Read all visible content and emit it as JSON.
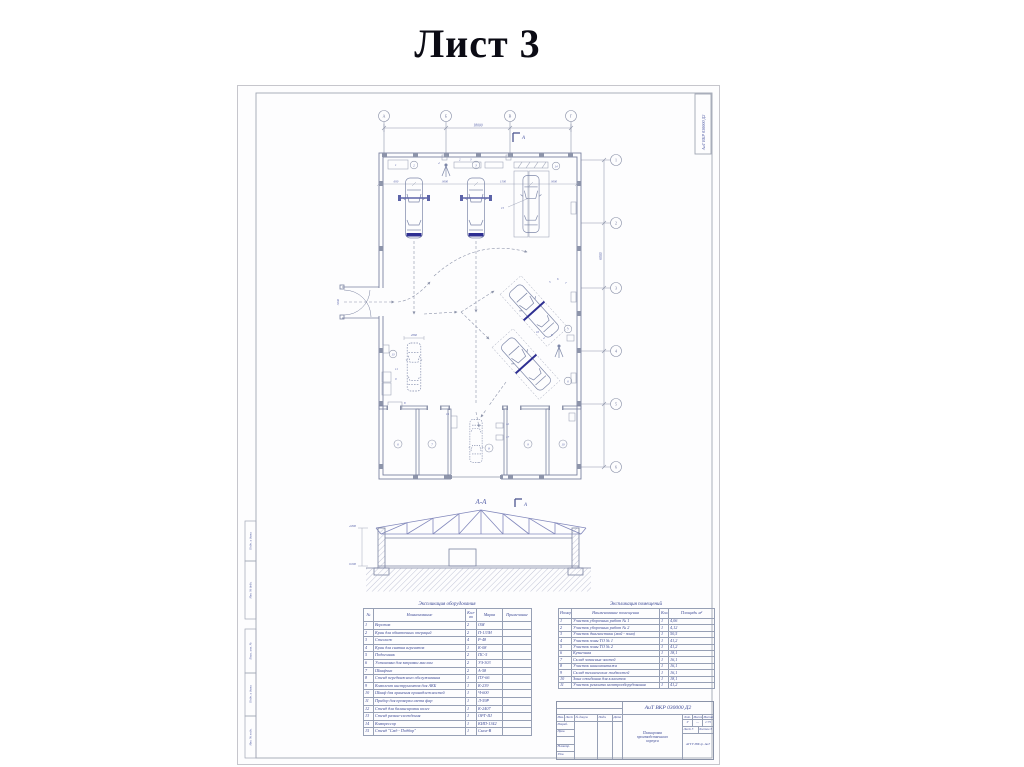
{
  "page": {
    "title": "Лист 3"
  },
  "sheet": {
    "code": "АиТ ВКР 030000 Д2",
    "margin_boxes": [
      "Подп. и дата",
      "Инв. № дубл.",
      "Взам. инв. №",
      "Подп. и дата",
      "Инв. № подл."
    ]
  },
  "plan": {
    "axes_top": [
      "А",
      "Б",
      "В",
      "Г"
    ],
    "axes_right": [
      "1",
      "2",
      "3",
      "4",
      "5",
      "6"
    ],
    "dim_total_top": "18000",
    "dim_right": "6000",
    "dim_inner": [
      "600",
      "3600",
      "1500",
      "3600"
    ],
    "dim_gate": "3000",
    "dim_car": "2060",
    "section_mark": "А",
    "room_numbers": [
      "6",
      "7",
      "8",
      "9",
      "10"
    ],
    "circled": [
      "2",
      "3",
      "14",
      "7",
      "6",
      "13"
    ],
    "marks": [
      "1",
      "2",
      "3",
      "4",
      "15",
      "5",
      "6",
      "7",
      "4",
      "6",
      "10",
      "11",
      "9",
      "8",
      "12",
      "17",
      "16"
    ]
  },
  "section": {
    "title": "А-А",
    "mark": "А",
    "dim_height": "4.800",
    "dim_zero": "0.000"
  },
  "equipment_table": {
    "title": "Экспликация оборудования",
    "headers": {
      "num": "№",
      "name": "Наименование",
      "qty": "Кол-во",
      "mark": "Марка",
      "note": "Примечание"
    },
    "rows": [
      {
        "n": "1",
        "name": "Верстак",
        "q": "2",
        "m": "ОМ"
      },
      {
        "n": "2",
        "name": "Кран для обкаточных операций",
        "q": "2",
        "m": "П-133Н"
      },
      {
        "n": "3",
        "name": "Стеллаж",
        "q": "4",
        "m": "Р-48"
      },
      {
        "n": "4",
        "name": "Кран для снятия агрегатов",
        "q": "1",
        "m": "К-08"
      },
      {
        "n": "5",
        "name": "Подъемник",
        "q": "2",
        "m": "ПС-5"
      },
      {
        "n": "6",
        "name": "Установка для заправки маслом",
        "q": "2",
        "m": "УЗ-303"
      },
      {
        "n": "7",
        "name": "Шкафчик",
        "q": "2",
        "m": "А-58"
      },
      {
        "n": "8",
        "name": "Стенд передвижного обслуживания",
        "q": "1",
        "m": "ПУ-66"
      },
      {
        "n": "9",
        "name": "Комплект инструментов для АКБ",
        "q": "1",
        "m": "К-239"
      },
      {
        "n": "10",
        "name": "Шкаф для хранения принадлежностей",
        "q": "1",
        "m": "Ч-600"
      },
      {
        "n": "11",
        "name": "Прибор для проверки света фар",
        "q": "1",
        "m": "Л-59Р"
      },
      {
        "n": "12",
        "name": "Стенд для балансировки колес",
        "q": "1",
        "m": "К-2407"
      },
      {
        "n": "13",
        "name": "Стенд развал-схождения",
        "q": "1",
        "m": "ОРГ-Ш"
      },
      {
        "n": "14",
        "name": "Компрессор",
        "q": "1",
        "m": "КИП-1342"
      },
      {
        "n": "15",
        "name": "Стенд \"Смд - Подбор\"",
        "q": "1",
        "m": "Смол-В"
      }
    ]
  },
  "premises_table": {
    "title": "Экспликация помещений",
    "headers": {
      "num": "Номер",
      "name": "Наименование помещения",
      "qty": "Кол.",
      "area": "Площадь м²"
    },
    "rows": [
      {
        "n": "1",
        "name": "Участок уборочных работ № 1",
        "q": "1",
        "a": "4,06"
      },
      {
        "n": "2",
        "name": "Участок уборочных работ № 2",
        "q": "1",
        "a": "4,12"
      },
      {
        "n": "3",
        "name": "Участок диагностики (мой - зона)",
        "q": "1",
        "a": "50,5"
      },
      {
        "n": "4",
        "name": "Участок зоны ТО № 1",
        "q": "1",
        "a": "41,2"
      },
      {
        "n": "5",
        "name": "Участок зоны ТО № 2",
        "q": "1",
        "a": "41,2"
      },
      {
        "n": "6",
        "name": "Кузнечная",
        "q": "1",
        "a": "18,1"
      },
      {
        "n": "7",
        "name": "Склад запасных частей",
        "q": "1",
        "a": "16,1"
      },
      {
        "n": "8",
        "name": "Участок шиномонтажа",
        "q": "1",
        "a": "16,1"
      },
      {
        "n": "9",
        "name": "Склад технических жидкостей",
        "q": "1",
        "a": "16,1"
      },
      {
        "n": "10",
        "name": "Зона ожидания для клиентов",
        "q": "1",
        "a": "18,1"
      },
      {
        "n": "11",
        "name": "Участок ремонта электрооборудования",
        "q": "1",
        "a": "41,2"
      }
    ]
  },
  "title_block": {
    "designation": "АиТ ВКР 030000 Д2",
    "name_lines": [
      "Планировка",
      "производственного",
      "корпуса"
    ],
    "header_cols": [
      "Изм.",
      "Лист",
      "№ докум.",
      "Подп.",
      "Дата"
    ],
    "role_rows": [
      "Разраб.",
      "Пров.",
      "",
      "Н.контр.",
      "Утв."
    ],
    "lit_label": "Лит.",
    "mass_label": "Масса",
    "scale_label": "Масштаб",
    "lit": "У",
    "mass": "—",
    "scale": "1:75",
    "sheet_label": "Лист",
    "sheet": "3",
    "sheets_label": "Листов",
    "sheets": "3",
    "org": "АГТУ ИФ гр. АиТ"
  }
}
